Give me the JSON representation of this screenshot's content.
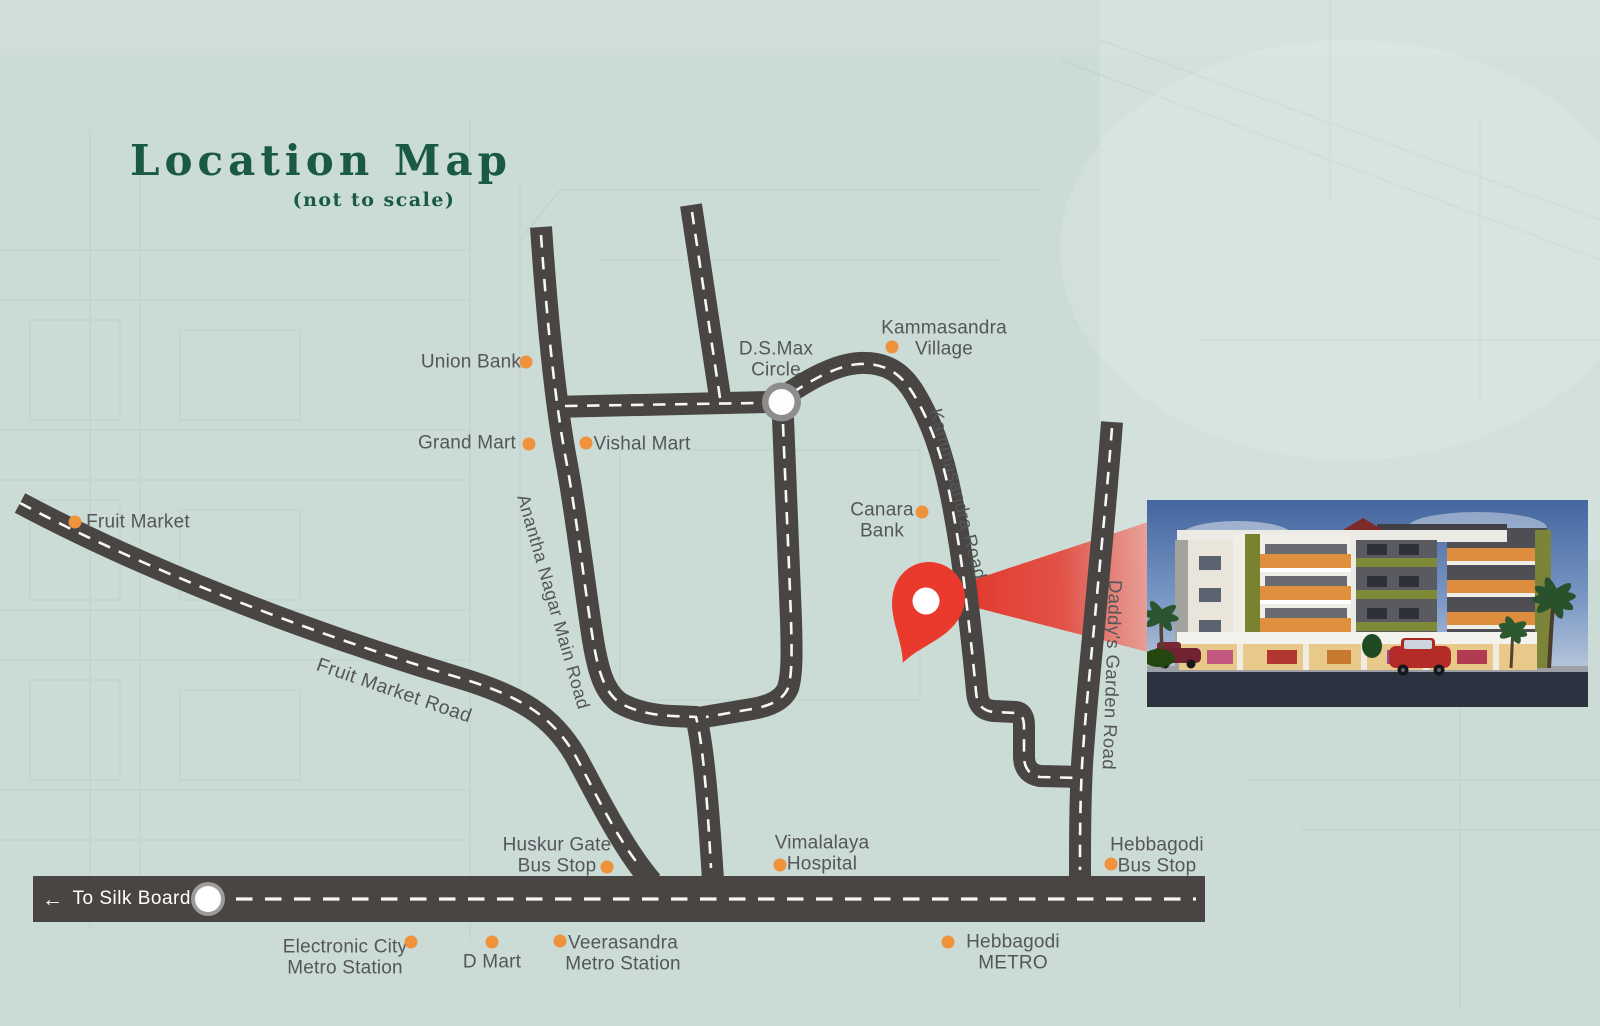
{
  "title": {
    "heading": "Location Map",
    "subtitle": "(not to scale)"
  },
  "colors": {
    "background": "#cbdcd6",
    "road": "#484543",
    "road_dash": "#f7f7f3",
    "title_green": "#1a5942",
    "label_gray": "#54565a",
    "marker_orange": "#f0913c",
    "pin_red": "#e93a2d",
    "circle_ring": "#919191"
  },
  "roads": {
    "fruit_market_road": "Fruit Market Road",
    "anantha_nagar_main_road": "Anantha Nagar Main Road",
    "kammasandra_road": "Kammasandra Road",
    "daddys_garden_road": "Daddy's Garden Road"
  },
  "junction": {
    "dsmax_circle": "D.S.Max\nCircle"
  },
  "direction": {
    "arrow_icon": "←",
    "to_silk_board": "To Silk Board"
  },
  "landmarks": {
    "fruit_market": "Fruit Market",
    "union_bank": "Union Bank",
    "grand_mart": "Grand Mart",
    "vishal_mart": "Vishal Mart",
    "kammasandra_village": "Kammasandra\nVillage",
    "canara_bank": "Canara\nBank",
    "huskur_gate_bus_stop": "Huskur Gate\nBus Stop",
    "vimalalaya_hospital": "Vimalalaya\nHospital",
    "hebbagodi_bus_stop": "Hebbagodi\nBus Stop",
    "electronic_city_metro": "Electronic City\nMetro Station",
    "d_mart": "D Mart",
    "veerasandra_metro": "Veerasandra\nMetro Station",
    "hebbagodi_metro": "Hebbagodi\nMETRO"
  }
}
